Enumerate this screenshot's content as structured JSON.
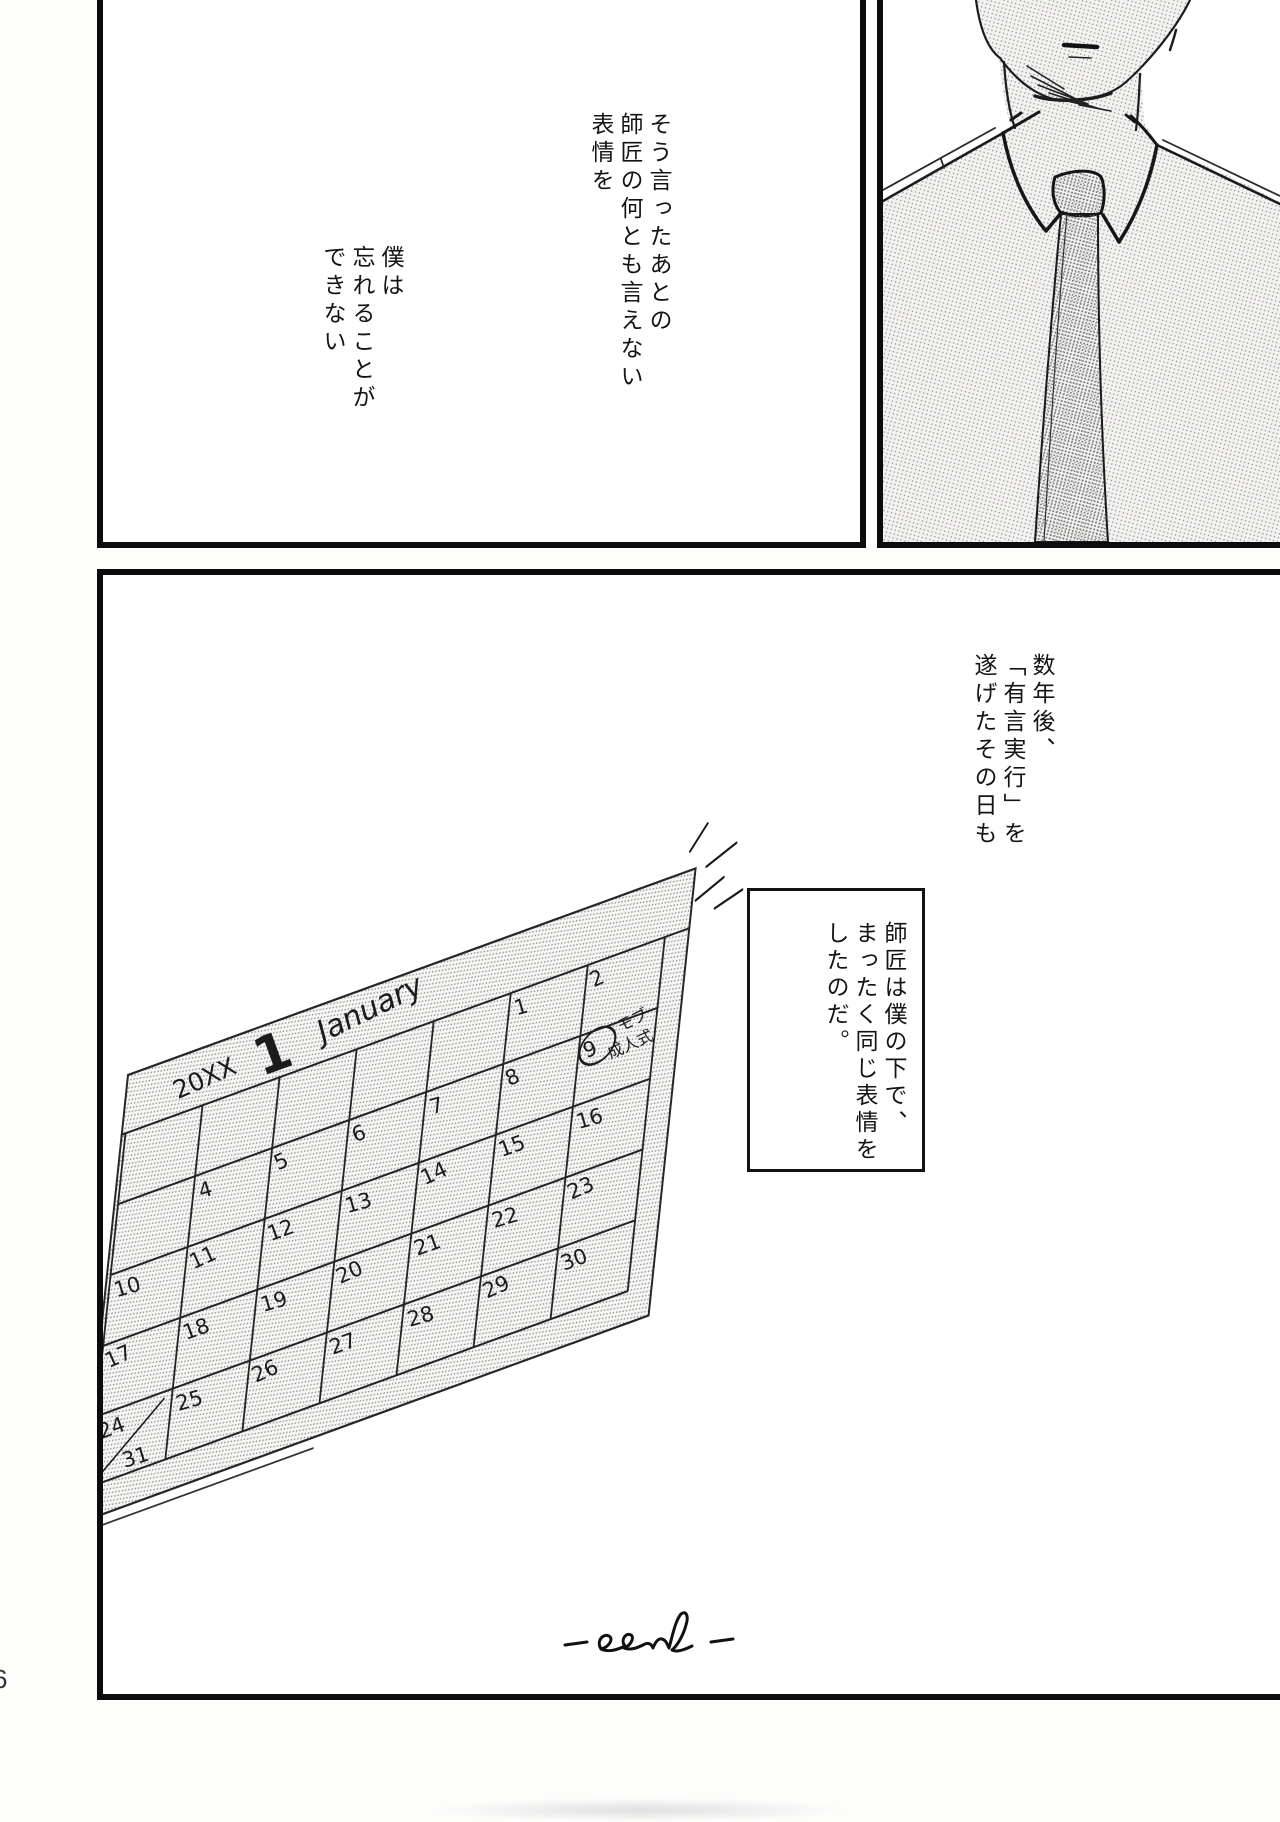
{
  "page": {
    "type_label": "manga-page",
    "page_number_partial": "6",
    "ink_color": "#141414",
    "paper_color": "#ffffff"
  },
  "panel_top_left": {
    "narration_right": [
      "そう言ったあとの",
      "師匠の何とも言えない",
      "表情を"
    ],
    "narration_left": [
      "僕は",
      "忘れることが",
      "できない"
    ]
  },
  "panel_top_right": {
    "illustration": "suit-collar-and-tie-figure"
  },
  "panel_bottom": {
    "narration_top_right": [
      "数年後、",
      "「有言実行」を",
      "遂げたその日も"
    ],
    "narration_box": [
      "師匠は僕の下で、",
      "まったく同じ表情を",
      "したのだ。"
    ],
    "end_mark": "-end-",
    "calendar": {
      "year": "20XX",
      "month_number": "1",
      "month_name": "January",
      "weeks": [
        [
          "",
          "",
          "",
          "",
          "",
          "1",
          "2"
        ],
        [
          "",
          "4",
          "5",
          "6",
          "7",
          "8",
          "9"
        ],
        [
          "10",
          "11",
          "12",
          "13",
          "14",
          "15",
          "16"
        ],
        [
          "17",
          "18",
          "19",
          "20",
          "21",
          "22",
          "23"
        ],
        [
          "24",
          "25",
          "26",
          "27",
          "28",
          "29",
          "30"
        ]
      ],
      "extra_date": "31",
      "circled_date": "9",
      "annotation": [
        "モブ",
        "成人式"
      ]
    }
  }
}
